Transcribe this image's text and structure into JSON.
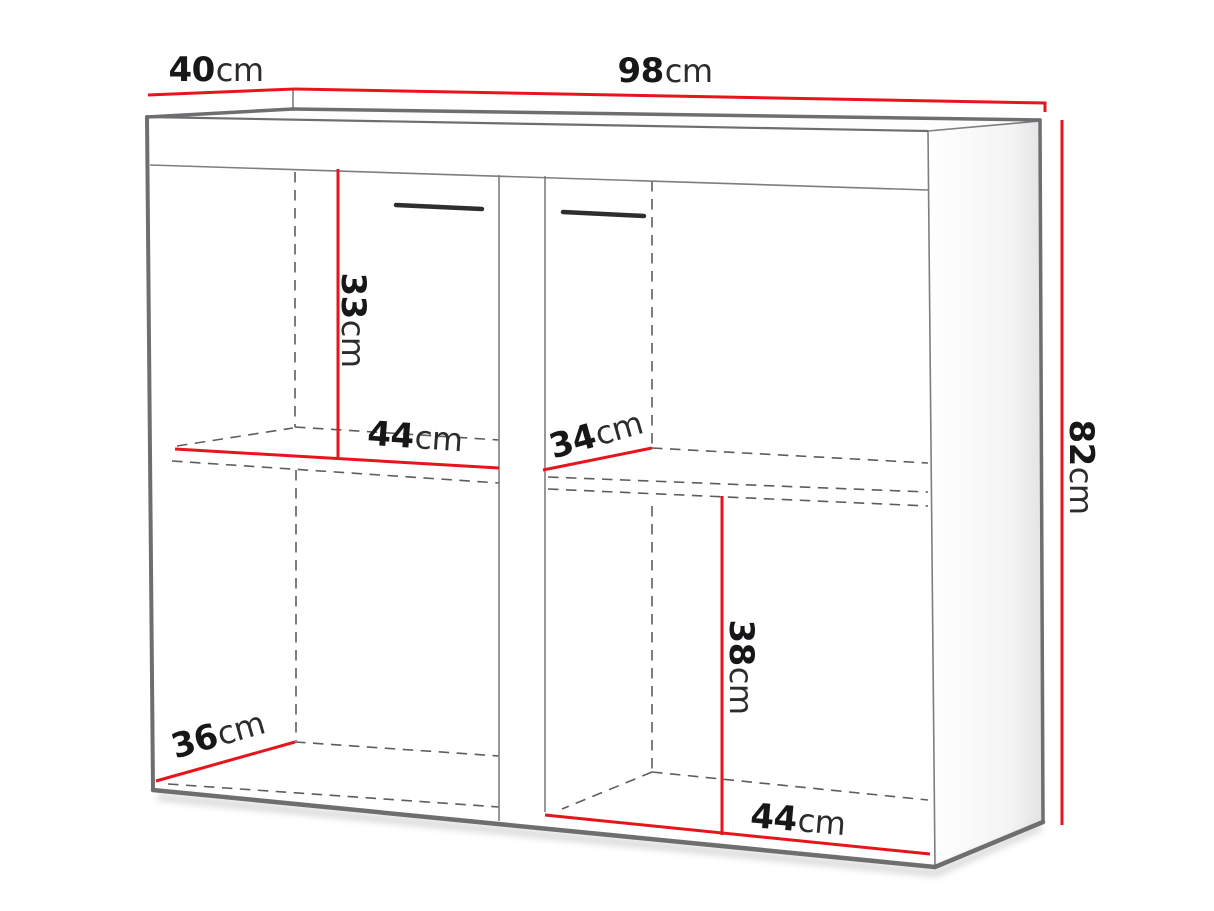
{
  "diagram": {
    "type": "furniture-dimension-drawing",
    "dimensions": {
      "depth_top": {
        "value": "40",
        "unit": "cm"
      },
      "width_top": {
        "value": "98",
        "unit": "cm"
      },
      "height_right": {
        "value": "82",
        "unit": "cm"
      },
      "shelf_height_left": {
        "value": "33",
        "unit": "cm"
      },
      "inner_width_left": {
        "value": "44",
        "unit": "cm"
      },
      "shelf_depth_right": {
        "value": "34",
        "unit": "cm"
      },
      "lower_height_right": {
        "value": "38",
        "unit": "cm"
      },
      "inner_width_right": {
        "value": "44",
        "unit": "cm"
      },
      "depth_bottom": {
        "value": "36",
        "unit": "cm"
      }
    },
    "colors": {
      "dimension_line": "#e8141b",
      "outline": "#6d6e70",
      "hidden_line": "#5c5d5f",
      "text": "#1d1d1f",
      "background": "#ffffff"
    }
  }
}
